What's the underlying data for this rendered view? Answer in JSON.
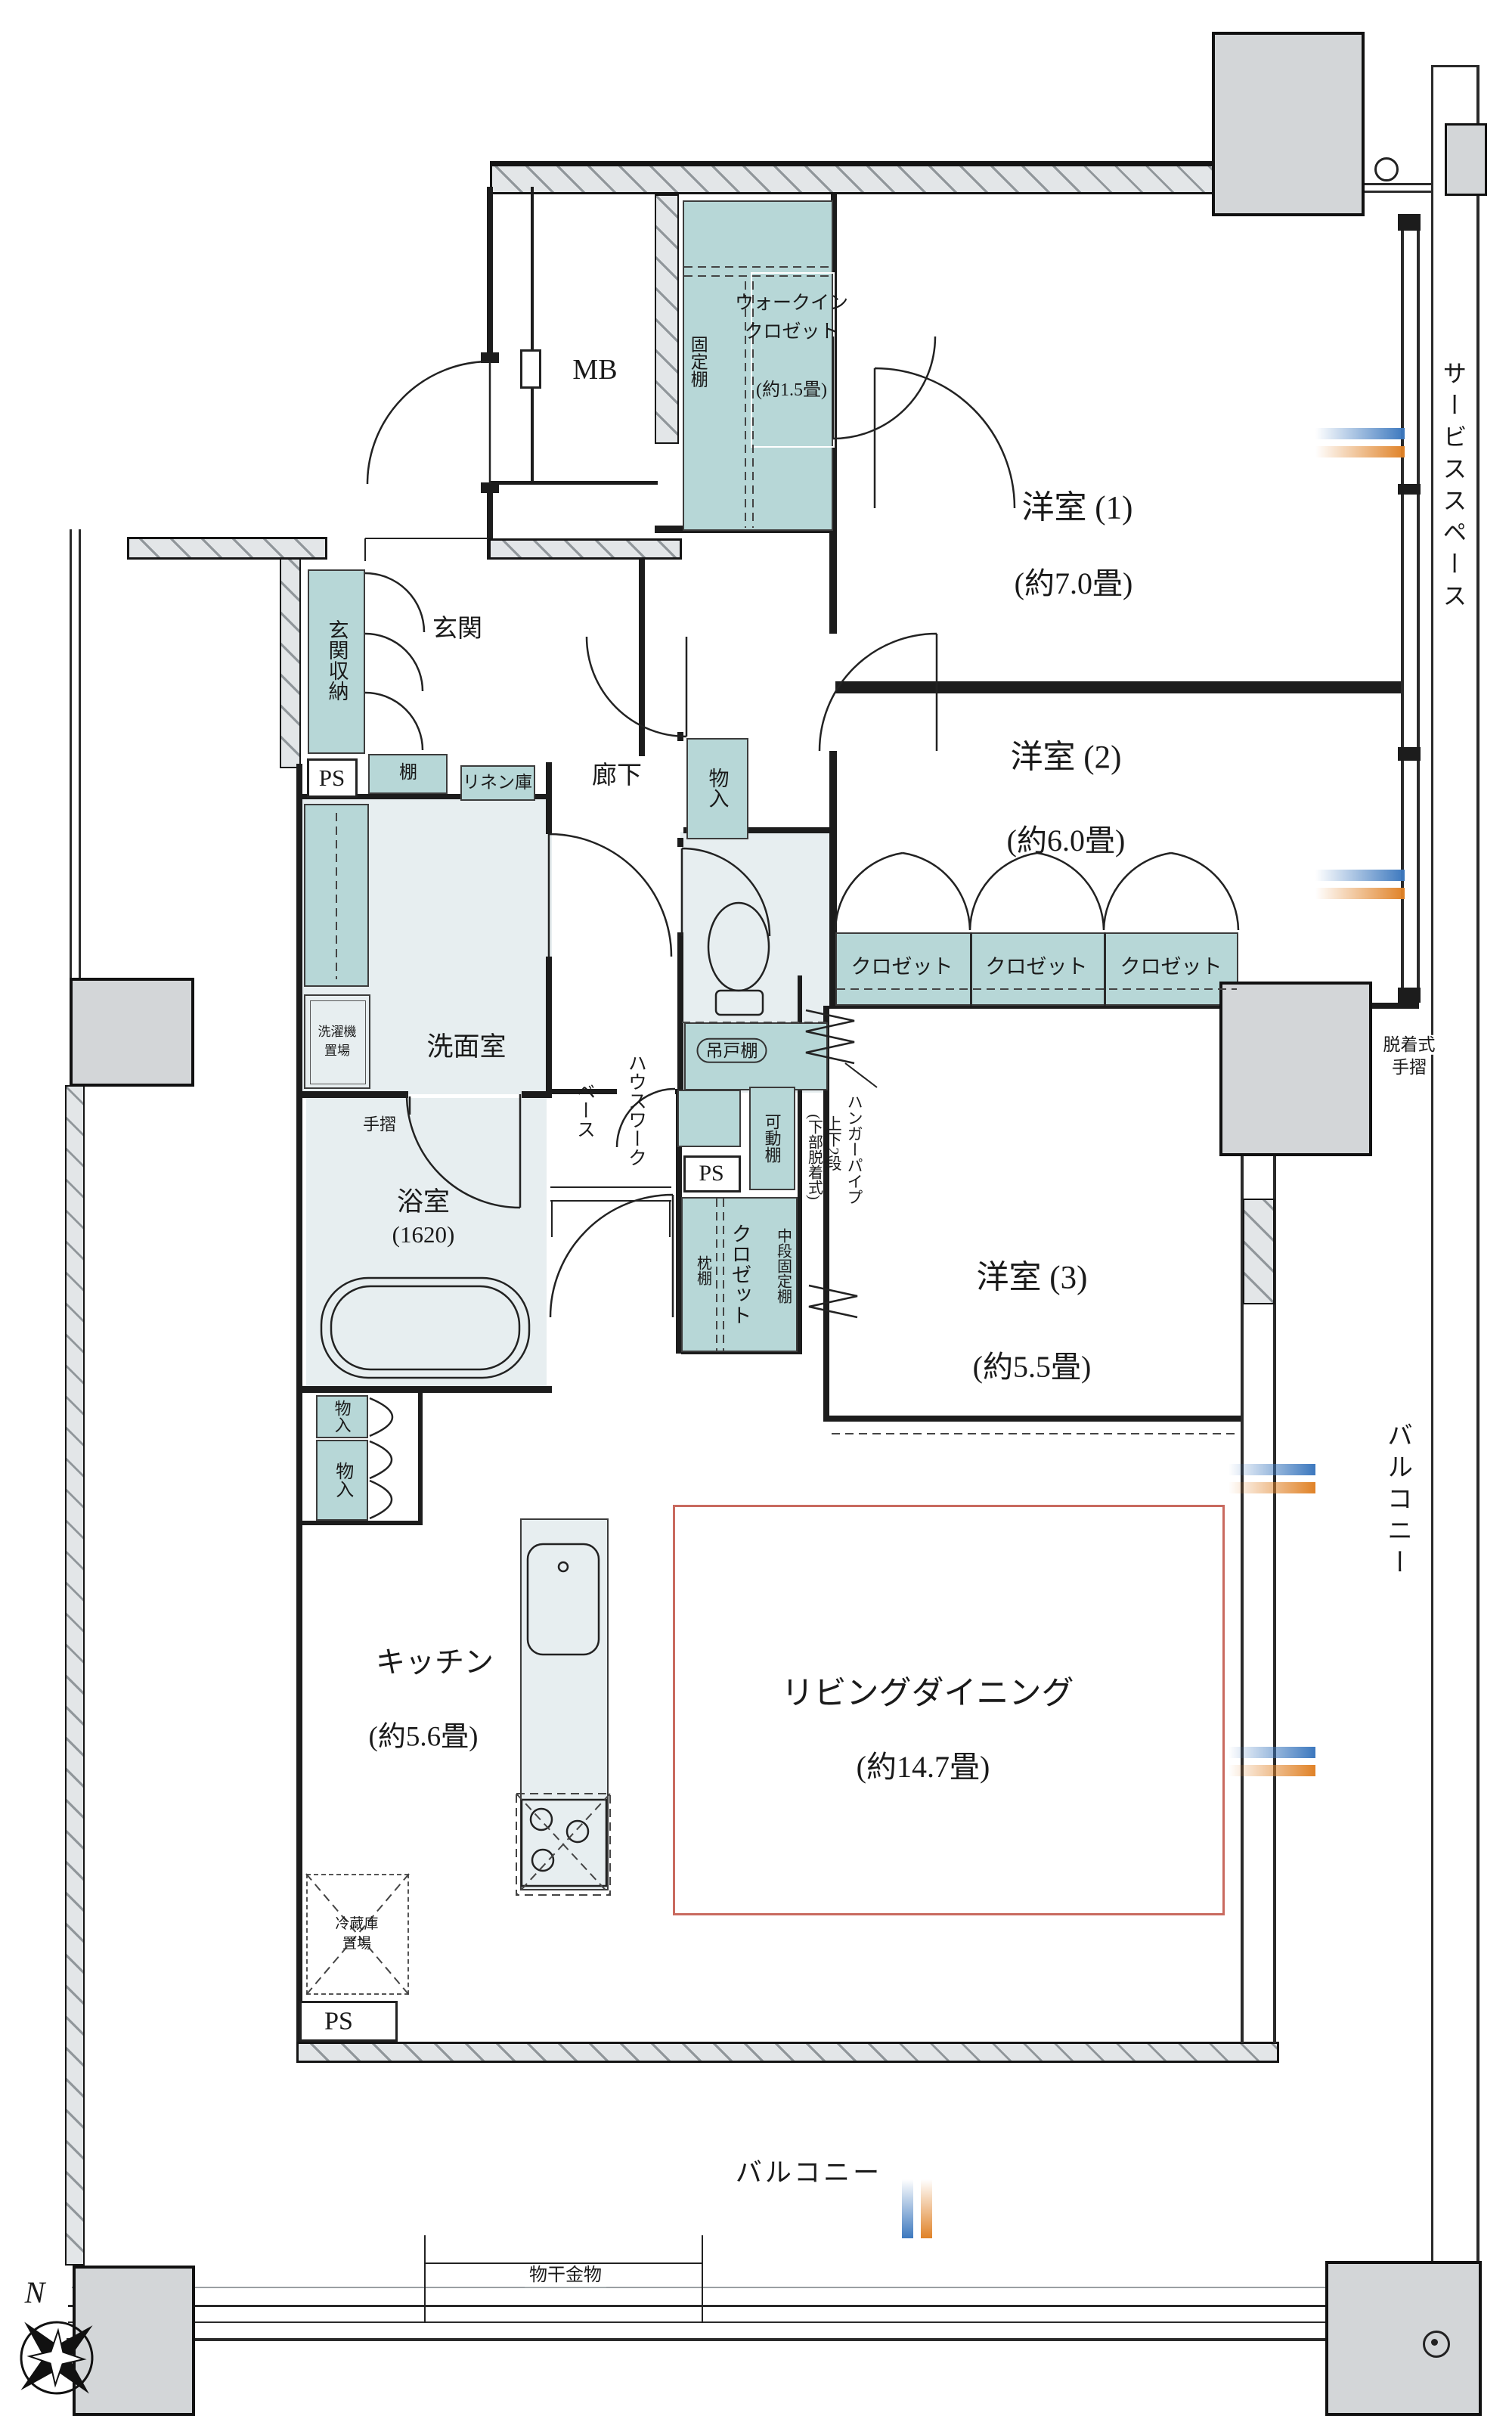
{
  "meta": {
    "drawing_type": "apartment floor plan"
  },
  "colors": {
    "storage_teal": "#b7d7d7",
    "room_light": "#e7eef0",
    "pillar_gray": "#d3d6d8",
    "ld_outline_red": "#c96a5f",
    "window_mark_blue": "#3c78be",
    "window_mark_orange": "#e08227"
  },
  "rooms": {
    "mb": {
      "label": "MB"
    },
    "wic": {
      "line1": "ウォークイン",
      "line2": "クロゼット",
      "size": "(約1.5畳)",
      "shelf": "固定棚"
    },
    "west1": {
      "name": "洋室 (1)",
      "size": "(約7.0畳)"
    },
    "west2": {
      "name": "洋室 (2)",
      "size": "(約6.0畳)"
    },
    "west3": {
      "name": "洋室 (3)",
      "size": "(約5.5畳)"
    },
    "ld": {
      "name": "リビングダイニング",
      "size": "(約14.7畳)"
    },
    "kitchen": {
      "name": "キッチン",
      "size": "(約5.6畳)"
    },
    "bath": {
      "name": "浴室",
      "size": "(1620)"
    },
    "washroom": {
      "name": "洗面室"
    },
    "genkan": {
      "name": "玄関"
    },
    "hallway": {
      "name": "廊下"
    }
  },
  "storage": {
    "genkan_shuno": "玄関収納",
    "shelf": "棚",
    "linen": "リネン庫",
    "mono_iri": "物入",
    "closet": "クロゼット",
    "kadou_dana": "可動棚",
    "makura_dana": "枕棚",
    "chudan_kotei_dana": "中段固定棚",
    "hanger_line1": "ハンガーパイプ",
    "hanger_line2": "上下2段",
    "hanger_line3": "(下部脱着式)",
    "tsurido_dana": "吊戸棚",
    "laundry_line1": "洗濯機",
    "laundry_line2": "置場",
    "fridge_line1": "冷蔵庫",
    "fridge_line2": "置場",
    "housework_line1": "ハウスワーク",
    "housework_line2": "ベース"
  },
  "outdoor": {
    "balcony": "バルコニー",
    "service_space": "サービススペース",
    "monohoshi": "物干金物",
    "dacchaku_line1": "脱着式",
    "dacchaku_line2": "手摺"
  },
  "fixtures": {
    "ps": "PS",
    "tesuri": "手摺",
    "compass_north": "N"
  }
}
